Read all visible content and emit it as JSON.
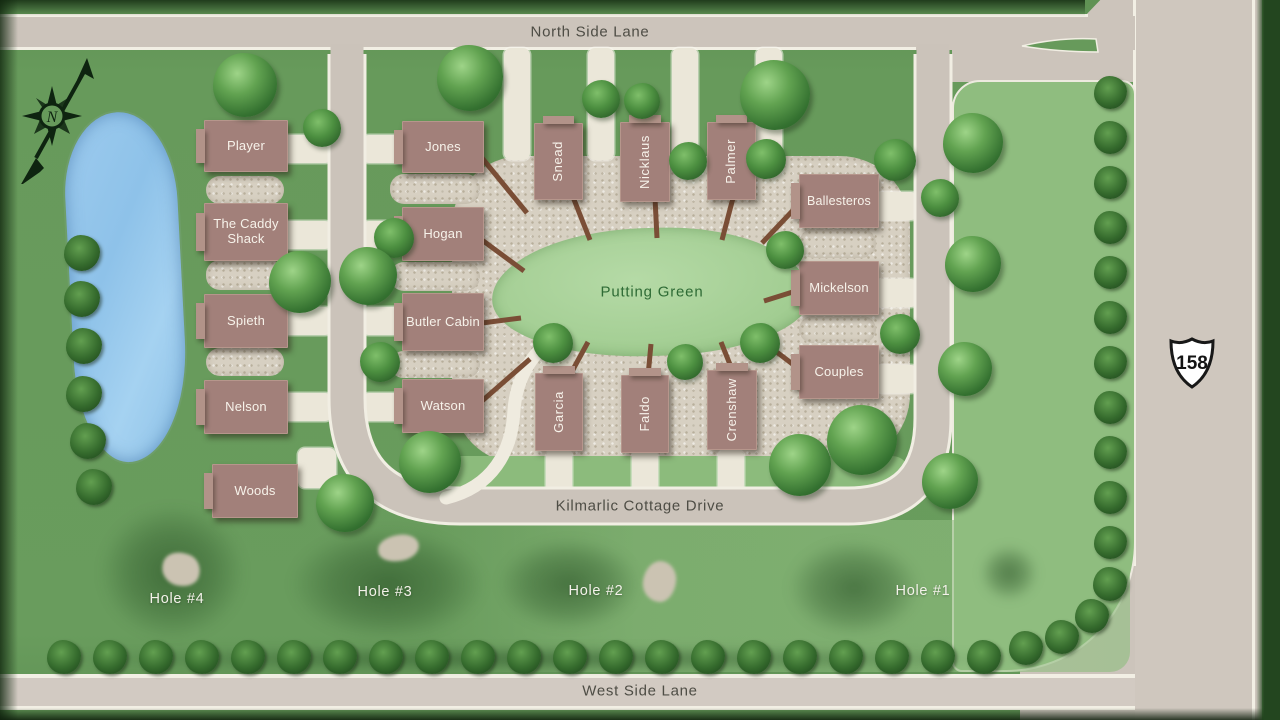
{
  "colors": {
    "grass": "#679a5b",
    "grass_light": "#8fbd7f",
    "road": "#ccc4bb",
    "road_edge": "#f2efe4",
    "gravel": "#d7d0c2",
    "driveway": "#ebe7d9",
    "cottage": "#a2807a",
    "cottage_text": "#f7f2ea",
    "water": "#93c5ea",
    "putting_green_fill": "#a5cf96",
    "boardwalk": "#7a4e36",
    "road_label_color": "#4e4d45",
    "putting_green_label_color": "#2e6b35"
  },
  "compass": {
    "label": "N"
  },
  "highway_shield": {
    "number": "158"
  },
  "roads": {
    "north": "North Side Lane",
    "west": "West Side Lane",
    "drive": "Kilmarlic Cottage Drive"
  },
  "putting_green": {
    "label": "Putting Green"
  },
  "cottages": [
    {
      "id": "player",
      "label": "Player"
    },
    {
      "id": "caddy-shack",
      "label": "The Caddy Shack"
    },
    {
      "id": "spieth",
      "label": "Spieth"
    },
    {
      "id": "nelson",
      "label": "Nelson"
    },
    {
      "id": "woods",
      "label": "Woods"
    },
    {
      "id": "jones",
      "label": "Jones"
    },
    {
      "id": "hogan",
      "label": "Hogan"
    },
    {
      "id": "butler-cabin",
      "label": "Butler Cabin"
    },
    {
      "id": "watson",
      "label": "Watson"
    },
    {
      "id": "snead",
      "label": "Snead"
    },
    {
      "id": "nicklaus",
      "label": "Nicklaus"
    },
    {
      "id": "palmer",
      "label": "Palmer"
    },
    {
      "id": "garcia",
      "label": "Garcia"
    },
    {
      "id": "faldo",
      "label": "Faldo"
    },
    {
      "id": "crenshaw",
      "label": "Crenshaw"
    },
    {
      "id": "ballesteros",
      "label": "Ballesteros"
    },
    {
      "id": "mickelson",
      "label": "Mickelson"
    },
    {
      "id": "couples",
      "label": "Couples"
    }
  ],
  "holes": [
    {
      "id": "hole-4",
      "label": "Hole #4"
    },
    {
      "id": "hole-3",
      "label": "Hole #3"
    },
    {
      "id": "hole-2",
      "label": "Hole #2"
    },
    {
      "id": "hole-1",
      "label": "Hole #1"
    }
  ]
}
